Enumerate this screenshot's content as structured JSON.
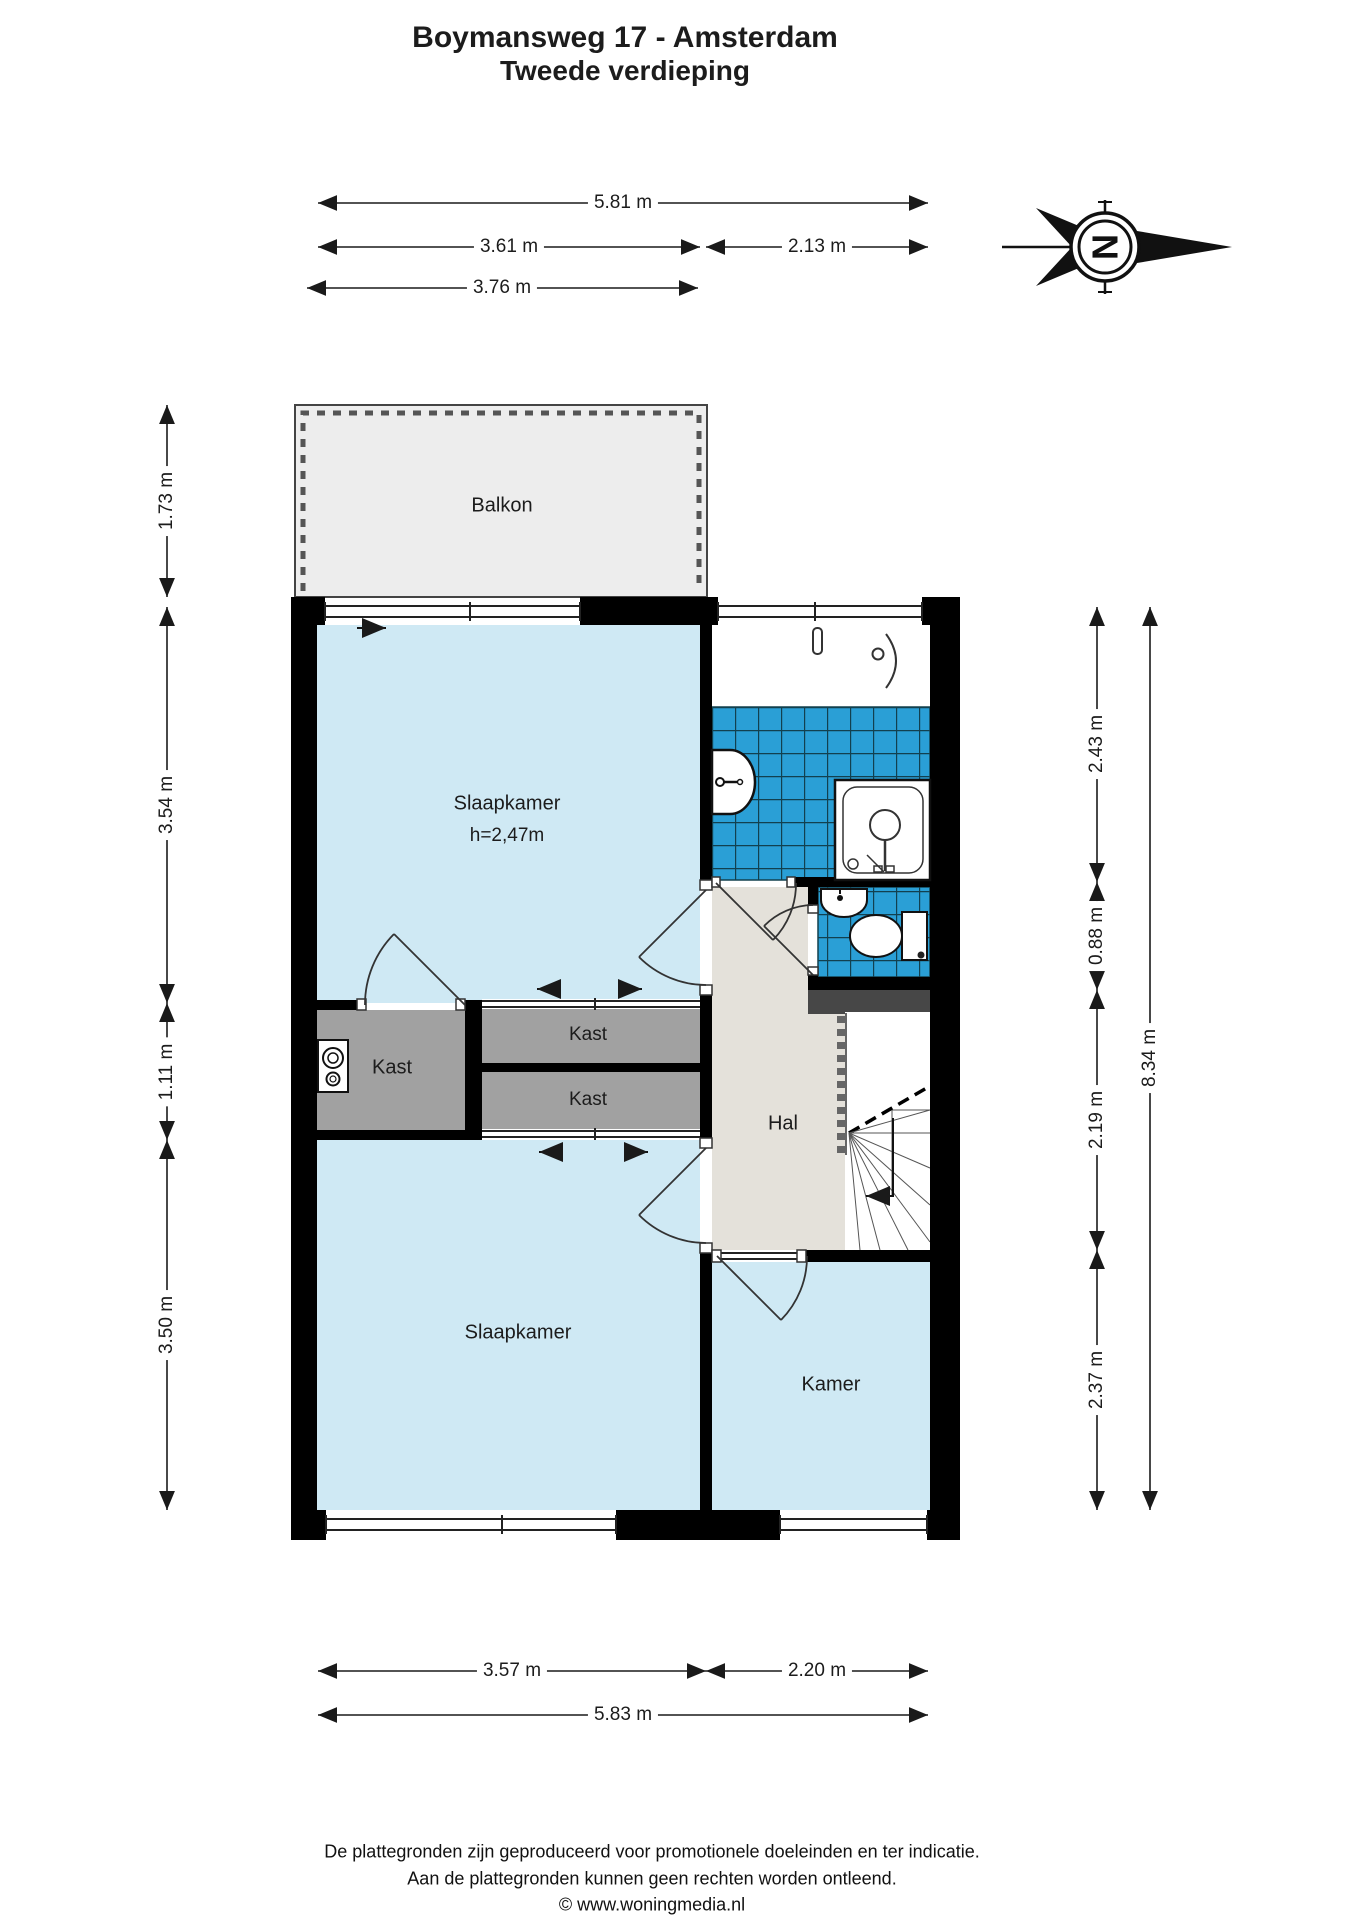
{
  "title": {
    "line1": "Boymansweg 17 - Amsterdam",
    "line2": "Tweede verdieping"
  },
  "compass": {
    "letter": "N"
  },
  "rooms": {
    "balkon": "Balkon",
    "slaapkamer1": "Slaapkamer",
    "slaapkamer1_h": "h=2,47m",
    "kast1": "Kast",
    "kast2": "Kast",
    "kast3": "Kast",
    "hal": "Hal",
    "slaapkamer2": "Slaapkamer",
    "kamer": "Kamer"
  },
  "dims": {
    "t_total": "5.81 m",
    "t_left": "3.61 m",
    "t_right": "2.13 m",
    "t_balkon": "3.76 m",
    "l_balkon": "1.73 m",
    "l_slaapkamer1": "3.54 m",
    "l_kast": "1.11 m",
    "l_slaapkamer2": "3.50 m",
    "r_badkamer": "2.43 m",
    "r_wc": "0.88 m",
    "r_hal": "2.19 m",
    "r_kamer": "2.37 m",
    "r_total": "8.34 m",
    "b_left": "3.57 m",
    "b_right": "2.20 m",
    "b_total": "5.83 m"
  },
  "footer": {
    "line1": "De plattegronden zijn geproduceerd voor promotionele doeleinden en ter indicatie.",
    "line2": "Aan de plattegronden kunnen geen rechten worden ontleend.",
    "line3": "© www.woningmedia.nl"
  },
  "colors": {
    "room_fill": "#cfe9f4",
    "tile_fill": "#2a9fd6",
    "tile_grout": "#12404f",
    "hal_fill": "#e4e1da",
    "kast_fill": "#a1a1a1",
    "balkon_fill": "#ededed",
    "duct_fill": "#474747",
    "wall": "#000000"
  }
}
